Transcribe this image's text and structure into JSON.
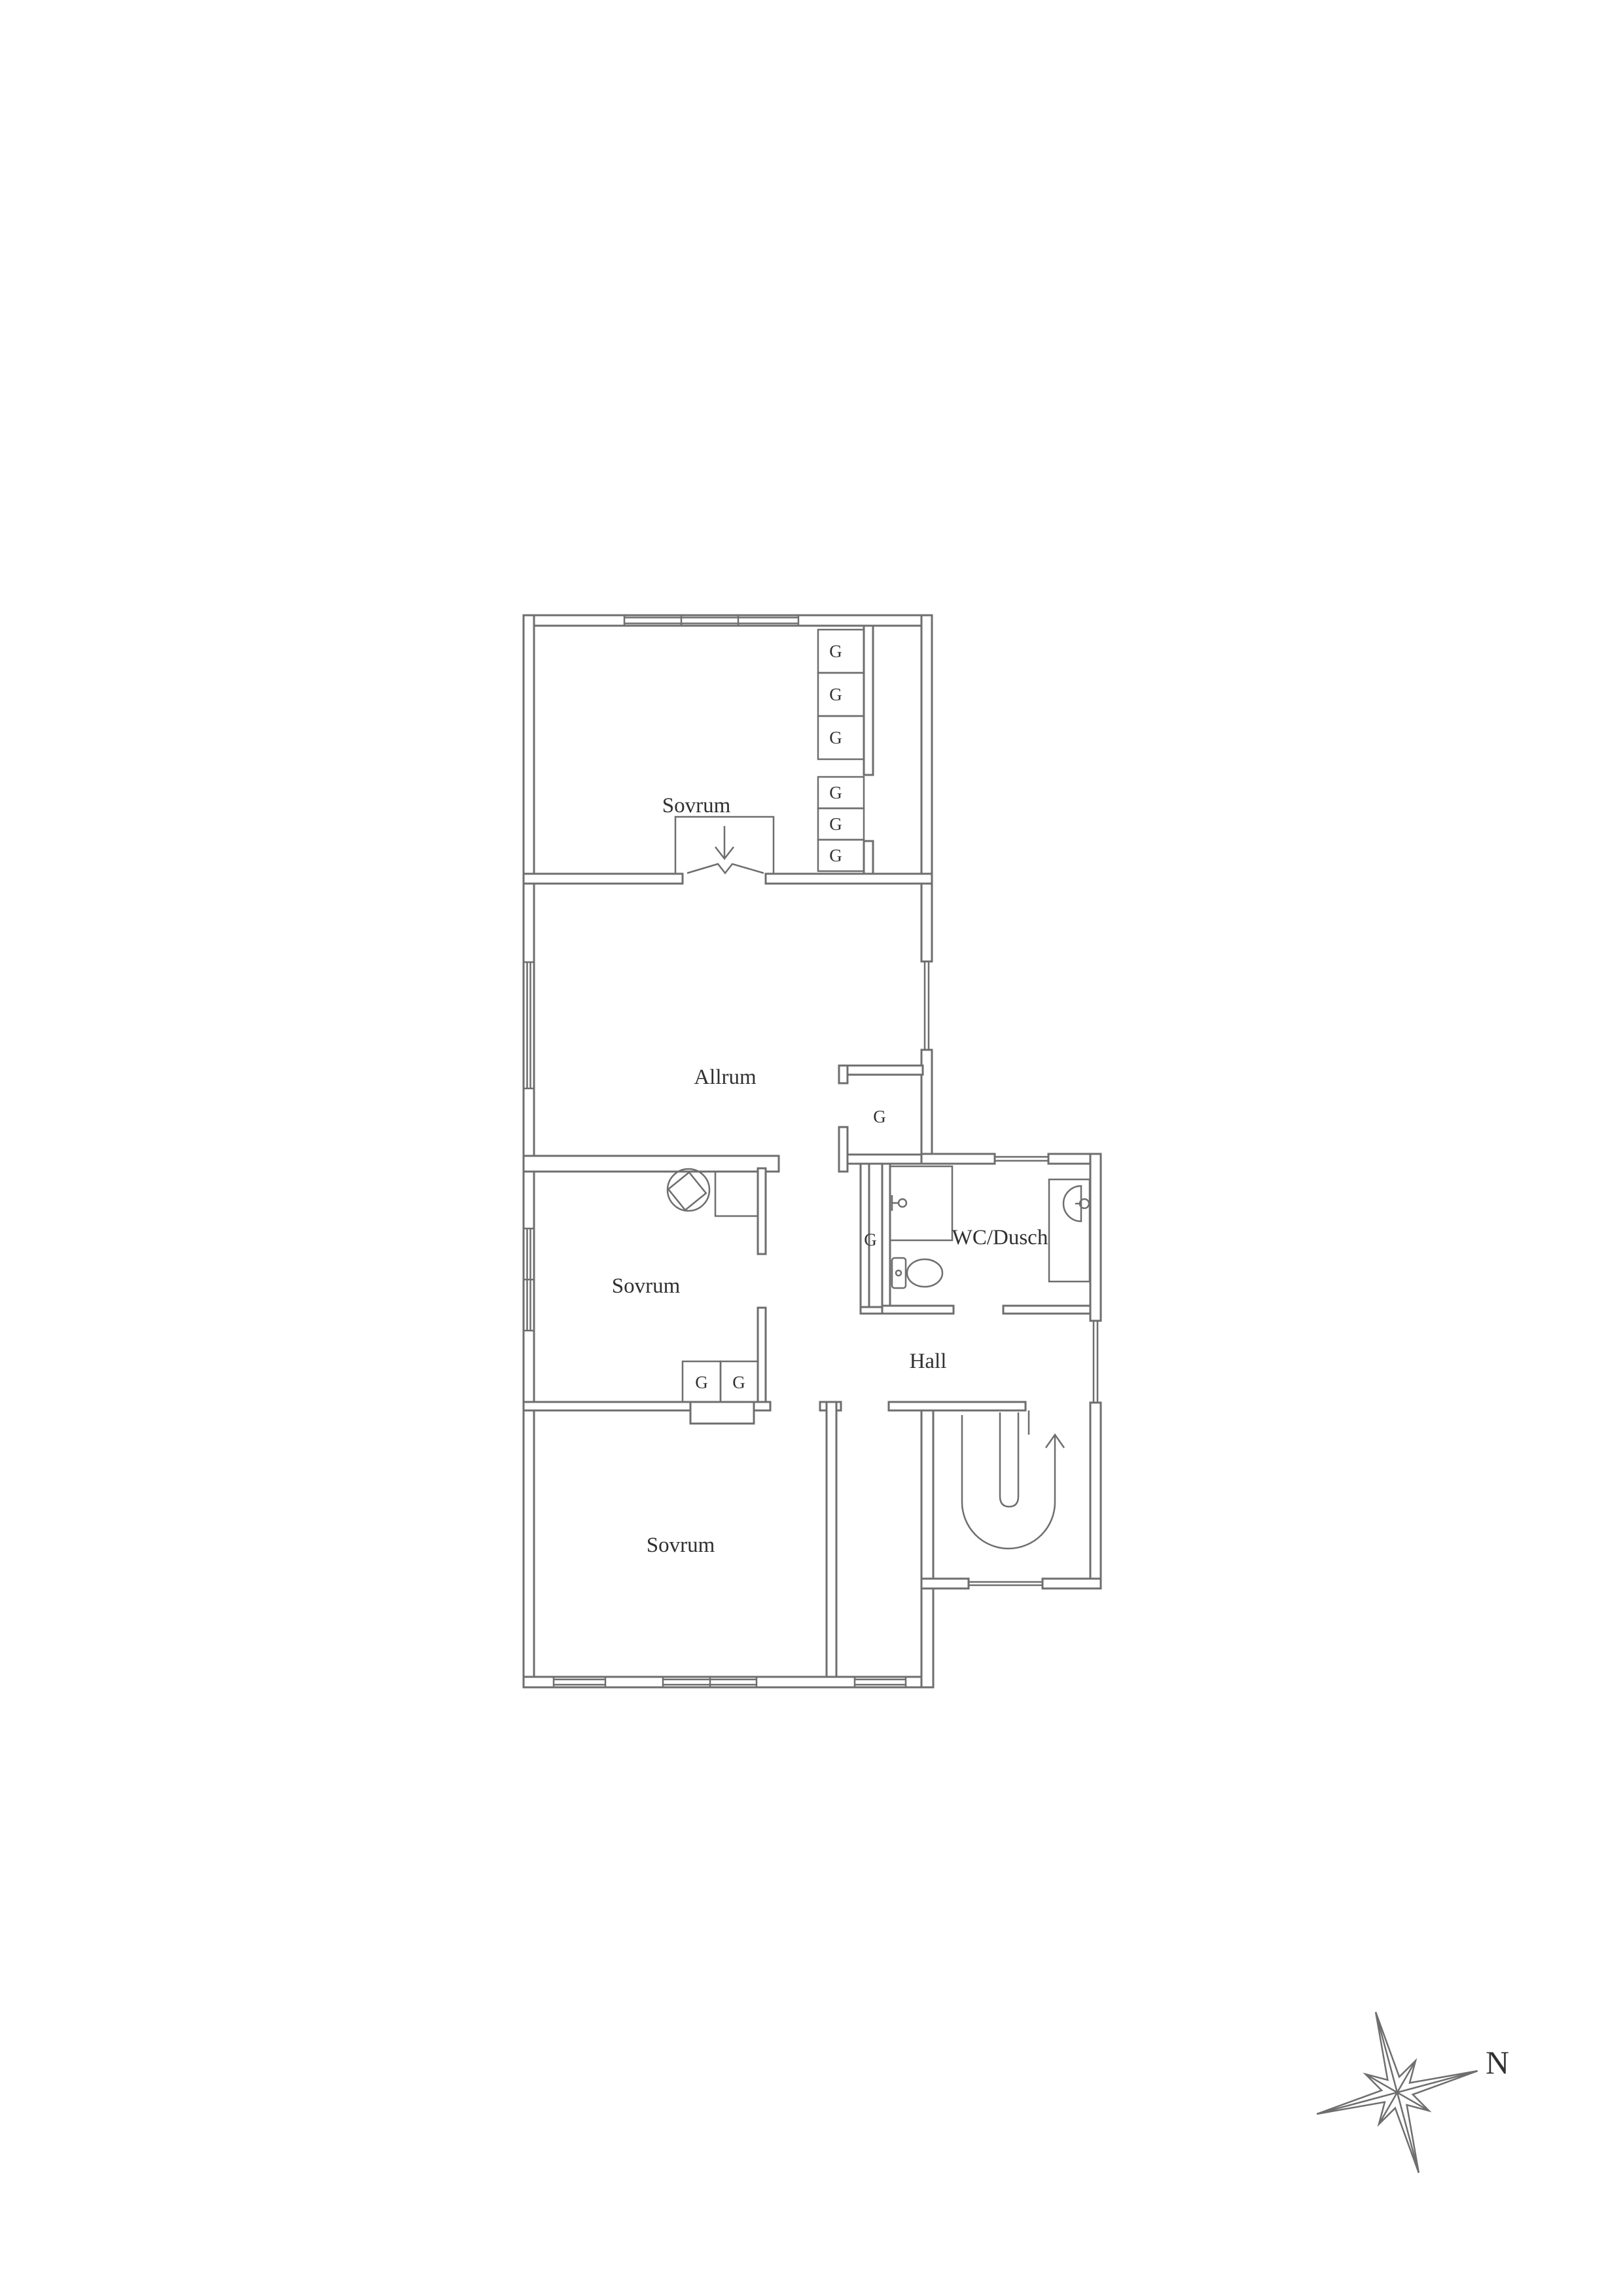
{
  "canvas": {
    "background": "#ffffff",
    "line_color": "#6e6e6e",
    "text_color": "#303030"
  },
  "floor_plan": {
    "rooms": [
      {
        "id": "sovrum-top",
        "label": "Sovrum"
      },
      {
        "id": "allrum",
        "label": "Allrum"
      },
      {
        "id": "sovrum-middle",
        "label": "Sovrum"
      },
      {
        "id": "wc-dusch",
        "label": "WC/Dusch"
      },
      {
        "id": "hall",
        "label": "Hall"
      },
      {
        "id": "sovrum-bottom",
        "label": "Sovrum"
      }
    ],
    "closet_g_label": "G",
    "closet_count": 10,
    "fixtures": [
      "tiled-stove",
      "shower",
      "toilet",
      "washbasin",
      "staircase-up"
    ],
    "compass": {
      "north_label": "N"
    }
  }
}
